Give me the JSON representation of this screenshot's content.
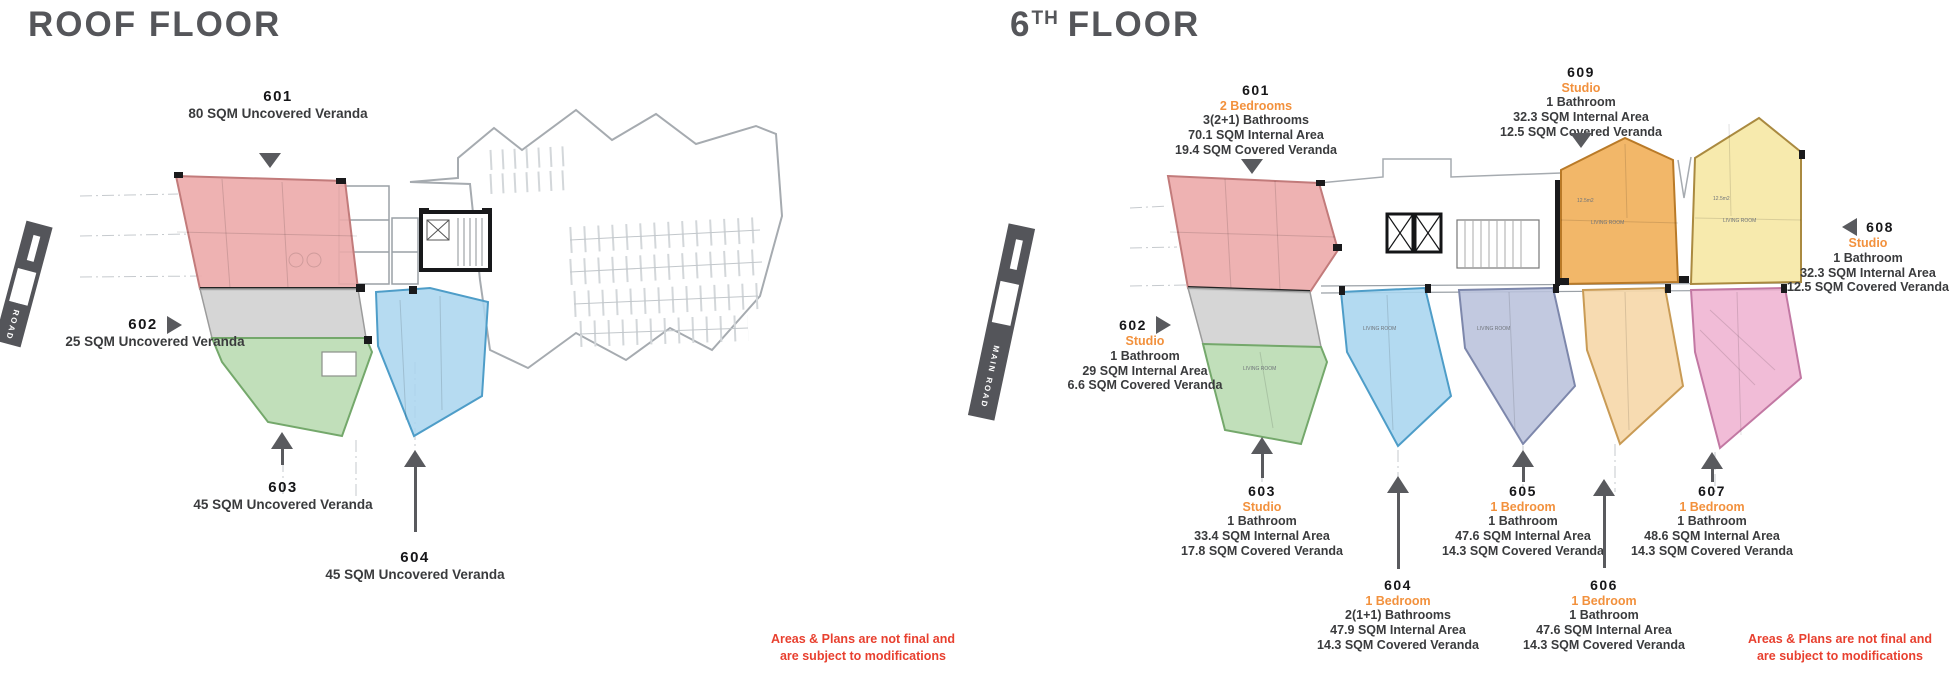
{
  "road_label": "MAIN ROAD",
  "disclaimer": [
    "Areas & Plans are not final and",
    "are subject to modifications"
  ],
  "palette": {
    "title_gray": "#55565A",
    "accent_orange": "#F2913D",
    "disclaimer_red": "#E8402F",
    "arrow_gray": "#595A5E",
    "road_gray": "#54555A",
    "unit_pink": "#ECAAAA",
    "unit_gray": "#D4D4D4",
    "unit_green": "#BADCB3",
    "unit_blue": "#A9D5EF",
    "unit_lavender": "#B9C2DC",
    "unit_amber": "#F1B15C",
    "unit_yellow": "#F6E8A6",
    "unit_peach": "#F6D7A9",
    "unit_magenta": "#EFB3D2"
  },
  "left_plan": {
    "title": "ROOF FLOOR",
    "units": {
      "u601": {
        "id": "601",
        "area": "80 SQM Uncovered Veranda"
      },
      "u602": {
        "id": "602",
        "area": "25 SQM Uncovered Veranda"
      },
      "u603": {
        "id": "603",
        "area": "45 SQM Uncovered Veranda"
      },
      "u604": {
        "id": "604",
        "area": "45 SQM Uncovered Veranda"
      }
    }
  },
  "right_plan": {
    "title": {
      "prefix": "6",
      "sup": "TH",
      "suffix": "FLOOR"
    },
    "units": {
      "u601": {
        "id": "601",
        "type": "2 Bedrooms",
        "bath": "3(2+1) Bathrooms",
        "internal": "70.1 SQM Internal Area",
        "veranda": "19.4 SQM Covered Veranda"
      },
      "u602": {
        "id": "602",
        "type": "Studio",
        "bath": "1 Bathroom",
        "internal": "29 SQM Internal Area",
        "veranda": "6.6 SQM Covered Veranda"
      },
      "u603": {
        "id": "603",
        "type": "Studio",
        "bath": "1 Bathroom",
        "internal": "33.4 SQM Internal Area",
        "veranda": "17.8 SQM Covered Veranda"
      },
      "u604": {
        "id": "604",
        "type": "1 Bedroom",
        "bath": "2(1+1) Bathrooms",
        "internal": "47.9 SQM Internal Area",
        "veranda": "14.3 SQM Covered Veranda"
      },
      "u605": {
        "id": "605",
        "type": "1 Bedroom",
        "bath": "1 Bathroom",
        "internal": "47.6 SQM Internal Area",
        "veranda": "14.3 SQM Covered Veranda"
      },
      "u606": {
        "id": "606",
        "type": "1 Bedroom",
        "bath": "1 Bathroom",
        "internal": "47.6 SQM Internal Area",
        "veranda": "14.3 SQM Covered Veranda"
      },
      "u607": {
        "id": "607",
        "type": "1 Bedroom",
        "bath": "1 Bathroom",
        "internal": "48.6 SQM Internal Area",
        "veranda": "14.3 SQM Covered Veranda"
      },
      "u608": {
        "id": "608",
        "type": "Studio",
        "bath": "1 Bathroom",
        "internal": "32.3 SQM Internal Area",
        "veranda": "12.5 SQM Covered Veranda"
      },
      "u609": {
        "id": "609",
        "type": "Studio",
        "bath": "1 Bathroom",
        "internal": "32.3 SQM Internal Area",
        "veranda": "12.5 SQM Covered Veranda"
      }
    }
  },
  "plan_annotations": {
    "living_room": "LIVING ROOM",
    "area_small": "12.5m2"
  }
}
